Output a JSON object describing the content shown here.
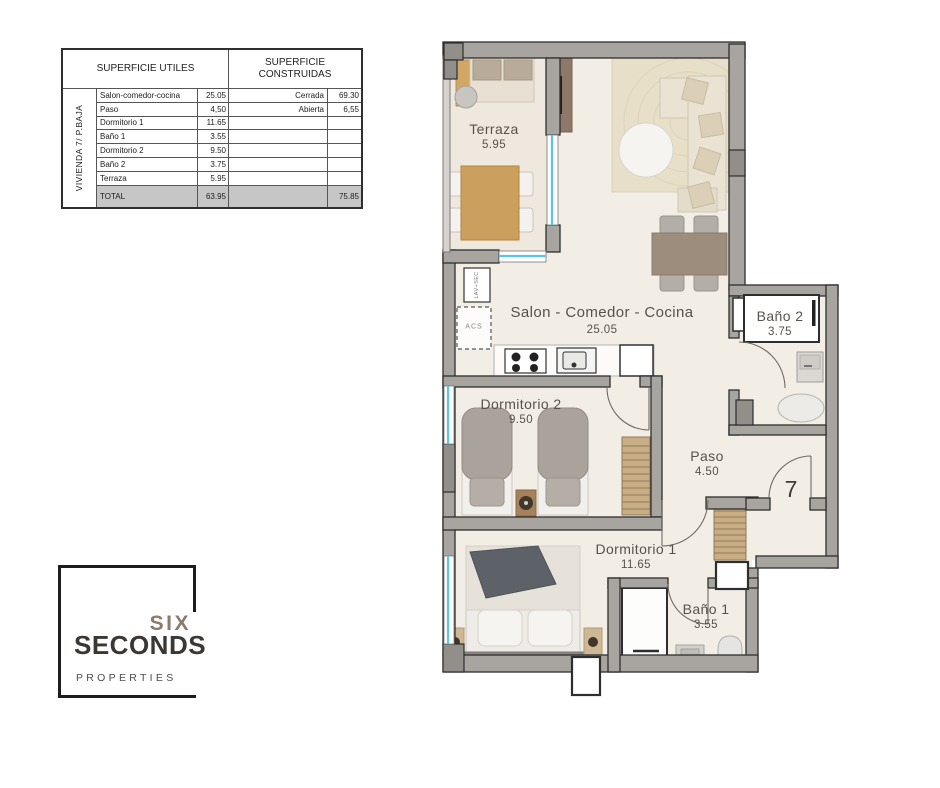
{
  "area_table": {
    "header_utiles": "SUPERFICIE UTILES",
    "header_construidas": "SUPERFICIE CONSTRUIDAS",
    "group_label": "VIVIENDA 7/ P.BAJA",
    "rows": [
      {
        "label": "Salon-comedor-cocina",
        "value": "25.05",
        "c_label": "Cerrada",
        "c_value": "69.30"
      },
      {
        "label": "Paso",
        "value": "4,50",
        "c_label": "Abierta",
        "c_value": "6,55"
      },
      {
        "label": "Dormitorio 1",
        "value": "11.65",
        "c_label": "",
        "c_value": ""
      },
      {
        "label": "Baño 1",
        "value": "3.55",
        "c_label": "",
        "c_value": ""
      },
      {
        "label": "Dormitorio 2",
        "value": "9.50",
        "c_label": "",
        "c_value": ""
      },
      {
        "label": "Baño 2",
        "value": "3.75",
        "c_label": "",
        "c_value": ""
      },
      {
        "label": "Terraza",
        "value": "5.95",
        "c_label": "",
        "c_value": ""
      }
    ],
    "total_row": {
      "label": "TOTAL",
      "value": "63.95",
      "c_label": "",
      "c_value": "75.85"
    }
  },
  "floor_plan": {
    "rooms": [
      {
        "name": "Terraza",
        "area": "5.95"
      },
      {
        "name": "Salon - Comedor - Cocina",
        "area": "25.05"
      },
      {
        "name": "Dormitorio 2",
        "area": "9.50"
      },
      {
        "name": "Paso",
        "area": "4.50"
      },
      {
        "name": "Baño 2",
        "area": "3.75"
      },
      {
        "name": "Dormitorio 1",
        "area": "11.65"
      },
      {
        "name": "Baño 1",
        "area": "3.55"
      }
    ],
    "unit_number": "7",
    "utility_labels": {
      "laundry": "LAV+SEC",
      "water_heater": "ACS"
    }
  },
  "logo": {
    "word1": "SIX",
    "word2": "SECONDS",
    "word3": "PROPERTIES"
  },
  "colors": {
    "wall": "#a8a5a1",
    "floor": "#f2eee6",
    "terrace_floor": "#efe8de",
    "window_glass": "#59c6e8",
    "wood": "#cb9f5e",
    "table_taupe": "#9d8d7c",
    "logo_six": "#8c7a6a",
    "total_row_bg": "#c6c6c6"
  }
}
